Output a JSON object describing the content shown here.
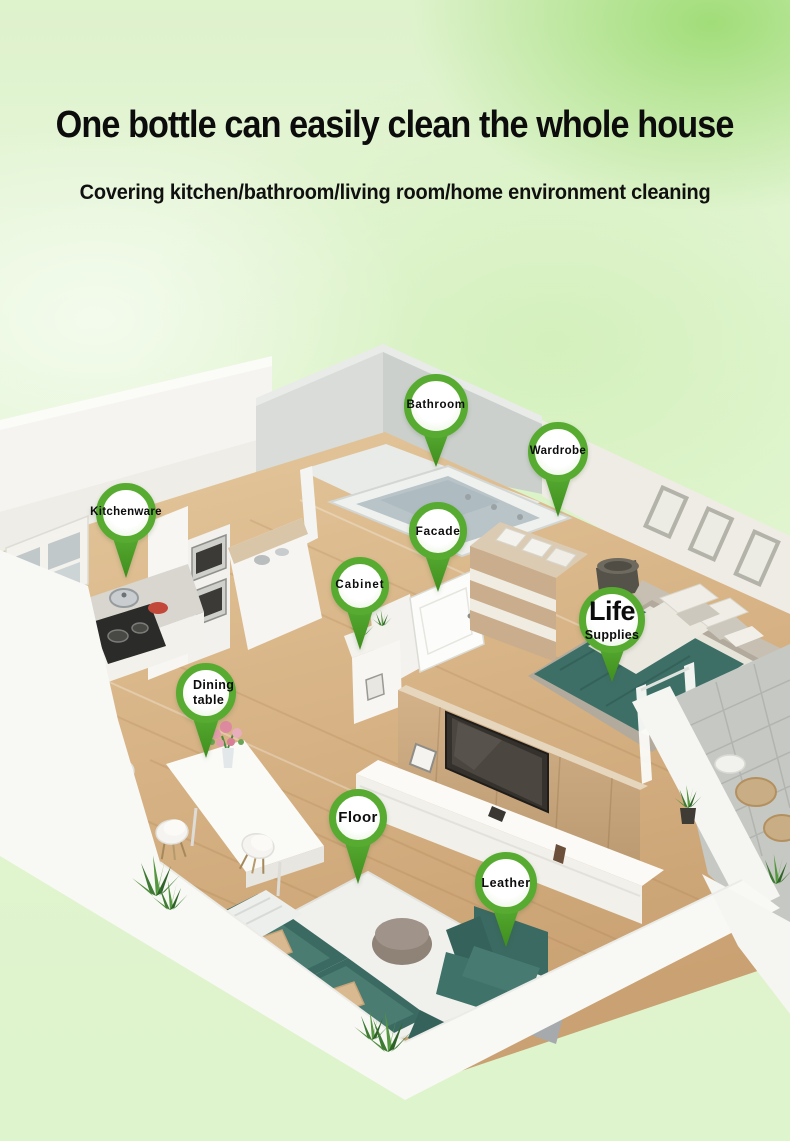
{
  "header": {
    "title": "One bottle can easily clean the whole house",
    "subtitle": "Covering kitchen/bathroom/living room/home environment cleaning"
  },
  "pins": [
    {
      "id": "bathroom",
      "label": "Bathroom"
    },
    {
      "id": "wardrobe",
      "label": "Wardrobe"
    },
    {
      "id": "kitchenware",
      "label": "Kitchenware"
    },
    {
      "id": "facade",
      "label": "Facade"
    },
    {
      "id": "cabinet",
      "label": "Cabinet"
    },
    {
      "id": "life_supplies",
      "label_primary": "Life",
      "label_secondary": "Supplies"
    },
    {
      "id": "dining_table",
      "label_line1": "Dining",
      "label_line2": "table"
    },
    {
      "id": "floor",
      "label": "Floor"
    },
    {
      "id": "leather",
      "label": "Leather"
    }
  ],
  "icons": {
    "pin": "location-pin-icon"
  },
  "colors": {
    "pin_green": "#57ab31",
    "background_green": "#e1f5d0",
    "sofa_teal": "#3c6d64",
    "bed_teal": "#3d6f66",
    "wood_floor": "#d7b385",
    "tv_wall_wood": "#c8a87e",
    "headline_text": "#0c0c0c"
  }
}
